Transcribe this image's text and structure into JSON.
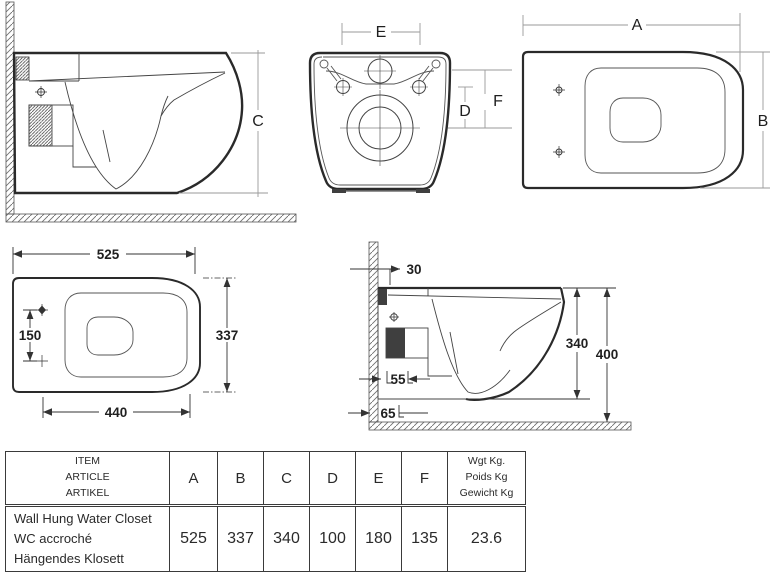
{
  "dims": {
    "a": "A",
    "b": "B",
    "c": "C",
    "d": "D",
    "e": "E",
    "f": "F",
    "d525": "525",
    "d337": "337",
    "d150": "150",
    "d440": "440",
    "d30": "30",
    "d55": "55",
    "d65": "65",
    "d340": "340",
    "d400": "400"
  },
  "table": {
    "item_header": [
      "ITEM",
      "ARTICLE",
      "ARTIKEL"
    ],
    "col_headers": [
      "A",
      "B",
      "C",
      "D",
      "E",
      "F"
    ],
    "weight_header": [
      "Wgt Kg.",
      "Poids Kg",
      "Gewicht Kg"
    ],
    "row": {
      "names": [
        "Wall Hung Water Closet",
        "WC accroché",
        "Hängendes Klosett"
      ],
      "values": [
        "525",
        "337",
        "340",
        "100",
        "180",
        "135"
      ],
      "weight": "23.6"
    }
  },
  "colors": {
    "line": "#2d2d2d",
    "dim_line_light": "#999999",
    "dark_fill": "#3f3f3f",
    "background": "#ffffff"
  }
}
